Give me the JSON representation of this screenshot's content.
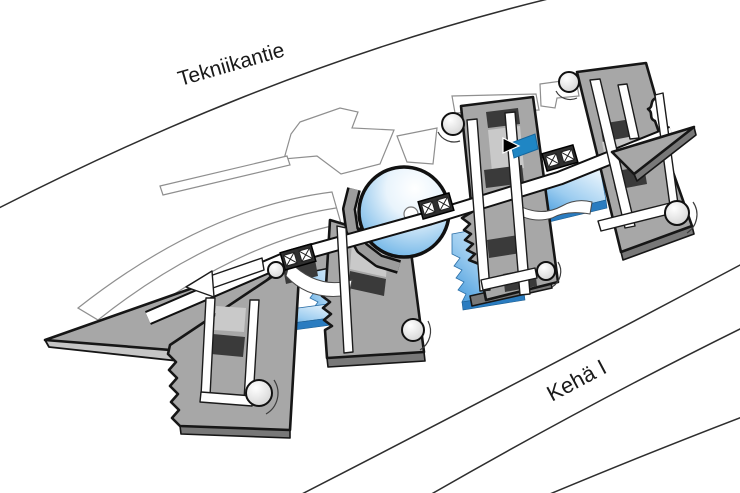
{
  "roads": {
    "tekniikantie": {
      "label": "Tekniikantie"
    },
    "keha_i": {
      "label": "Kehä I"
    }
  },
  "cursor": {
    "icon": "arrow-pointer",
    "transform": "translate(503,138)"
  },
  "colors": {
    "outline": "#161616",
    "roof": "#a7a7a7",
    "roof-light": "#c9c9c9",
    "roof-side": "#787878",
    "wedge-side": "#c6c6c6",
    "dark-band": "#3a3a3a",
    "context-line": "#8f8f8f",
    "road-line": "#2e2e2e",
    "glass-deep": "#3f97db",
    "glass-mid": "#9dcdf0",
    "glass-light": "#ecf6fd",
    "glass-edge": "#2a7cc0",
    "dome-blue": "#58a9e3",
    "highlight": "#1f86c4",
    "label": "#1a1a1a"
  }
}
